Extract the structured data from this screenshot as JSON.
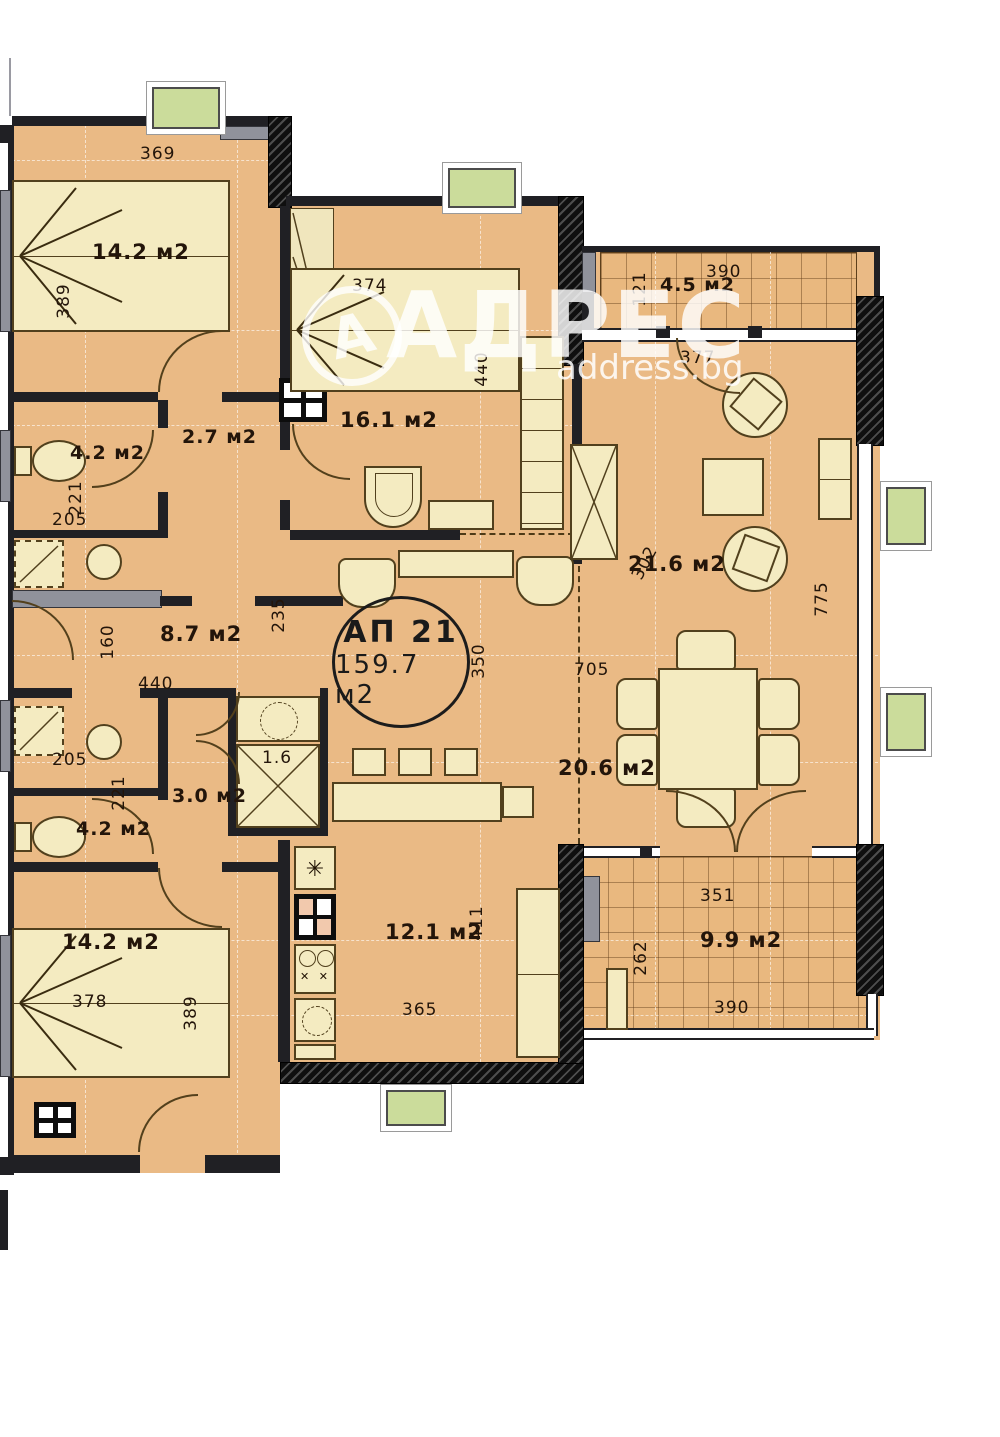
{
  "watermark": {
    "letter": "А",
    "brand": "АДРЕС",
    "site": "address.bg"
  },
  "unit": {
    "id": "АП 21",
    "area": "159.7 м2"
  },
  "rooms": {
    "bedroom_tl": "14.2 м2",
    "corridor": "2.7 м2",
    "bedroom_mid": "16.1 м2",
    "bath_top": "4.2 м2",
    "hall": "8.7 м2",
    "closet": "3.0 м2",
    "closet_small": "1.6",
    "bath_bottom": "4.2 м2",
    "bedroom_bl": "14.2 м2",
    "kitchen": "12.1 м2",
    "living": "21.6 м2",
    "dining": "20.6 м2",
    "balcony": "4.5 м2",
    "terrace": "9.9 м2"
  },
  "dims": {
    "bedroom_tl_width": "369",
    "bedroom_tl_height": "389",
    "bed_mid": "374",
    "bedroom_mid_height": "440",
    "balcony_depth": "121",
    "balcony_width": "390",
    "living_door_width": "377",
    "wardrobe_diag": "302",
    "living_height": "775",
    "dining_width": "705",
    "center_height": "350",
    "hall_right_height": "235",
    "hall_left_height": "160",
    "hall_width": "440",
    "bath_top_width": "205",
    "bath_top_height": "221",
    "bath_bottom_width": "205",
    "bath_bottom_height": "221",
    "kitchen_width": "365",
    "kitchen_height": "411",
    "bed_bl": "378",
    "bedroom_bl_height": "389",
    "terrace_top_width": "351",
    "terrace_depth": "262",
    "terrace_bottom_width": "390"
  },
  "icons": {
    "fridge": "✳",
    "sink_marks": "✕ ✕"
  },
  "colors": {
    "floor": "#eaba85",
    "furniture": "#f4ebc1",
    "wall": "#202024",
    "pillar_green": "#cbdc9b",
    "sill_gray": "#90929b"
  }
}
